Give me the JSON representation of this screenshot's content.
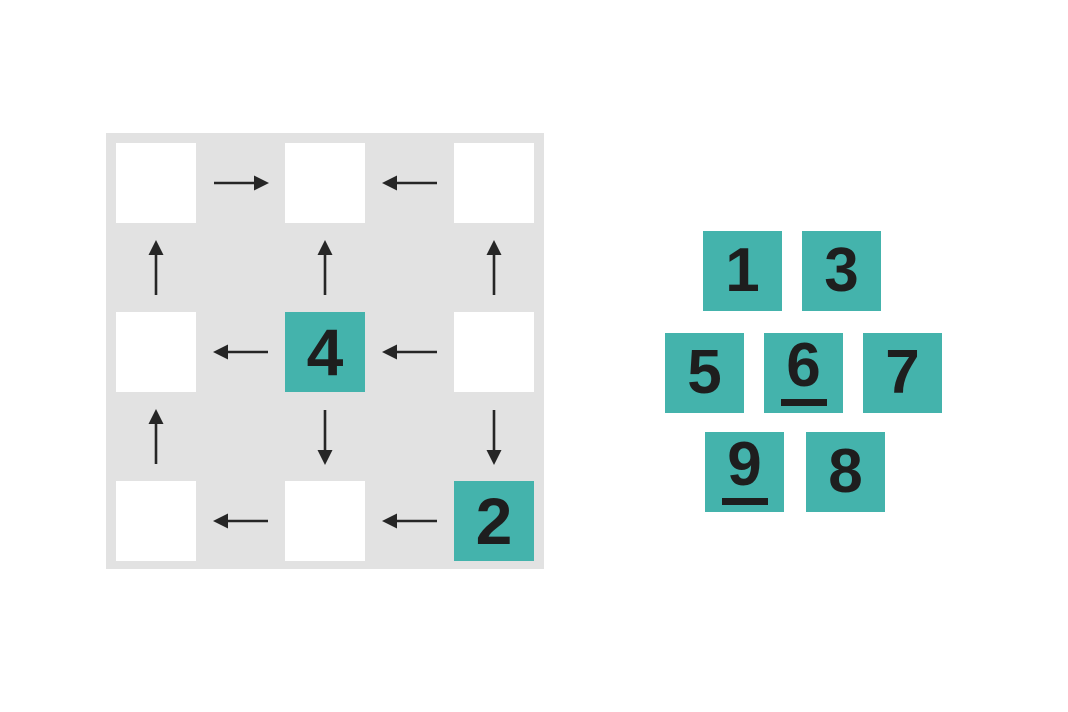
{
  "colors": {
    "background": "#ffffff",
    "board_background": "#e2e2e2",
    "cell_background": "#ffffff",
    "tile_background": "#44b3ac",
    "digit_color": "#1e1e1e",
    "arrow_color": "#262626"
  },
  "board": {
    "rows": 3,
    "cols": 3,
    "cells": [
      [
        "",
        "",
        ""
      ],
      [
        "",
        "4",
        ""
      ],
      [
        "",
        "",
        "2"
      ]
    ],
    "h_arrows": [
      [
        "right",
        "left"
      ],
      [
        "left",
        "left"
      ],
      [
        "left",
        "left"
      ]
    ],
    "v_arrows": [
      [
        "up",
        "up",
        "up"
      ],
      [
        "up",
        "down",
        "down"
      ]
    ]
  },
  "tiles": {
    "rows": [
      [
        {
          "value": "1",
          "underlined": false
        },
        {
          "value": "3",
          "underlined": false
        }
      ],
      [
        {
          "value": "5",
          "underlined": false
        },
        {
          "value": "6",
          "underlined": true
        },
        {
          "value": "7",
          "underlined": false
        }
      ],
      [
        {
          "value": "9",
          "underlined": true
        },
        {
          "value": "8",
          "underlined": false
        }
      ]
    ]
  }
}
